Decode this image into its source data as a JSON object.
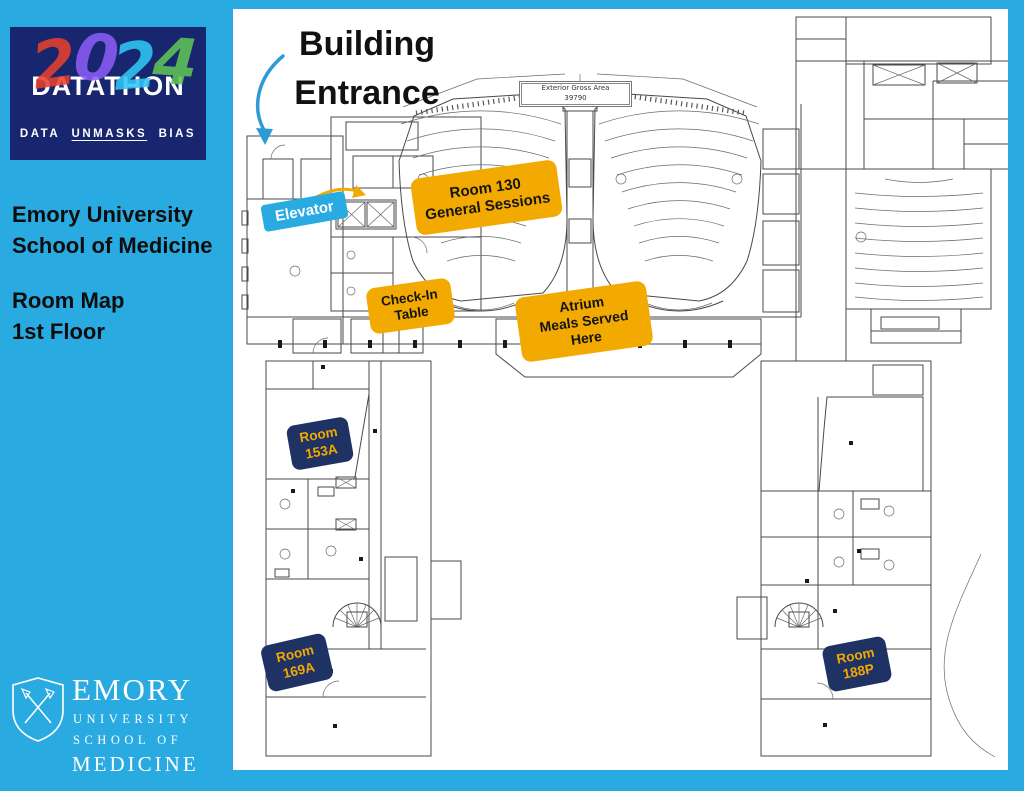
{
  "colors": {
    "background": "#29ABE2",
    "logo_navy": "#17266E",
    "label_orange": "#F2A900",
    "label_navy": "#1E3264",
    "label_gold_text": "#F2A900",
    "elevator_cyan": "#29ABE2",
    "entrance_arrow_blue": "#2E9BD6",
    "digit_colors": [
      "#E8412E",
      "#8B5CF6",
      "#30C6F4",
      "#5FC457"
    ]
  },
  "sidebar": {
    "logo": {
      "title": "DATATHON",
      "year_digits": [
        "2",
        "0",
        "2",
        "4"
      ],
      "tagline_words": [
        {
          "text": "DATA"
        },
        {
          "text": "UNMASKS"
        },
        {
          "text": "BIAS"
        }
      ]
    },
    "org_line1": "Emory University",
    "org_line2": "School of Medicine",
    "map_line1": "Room Map",
    "map_line2": "1st Floor",
    "footer_logo": {
      "name": "EMORY",
      "sub1": "UNIVERSITY",
      "sub2": "SCHOOL OF",
      "sub3": "MEDICINE"
    }
  },
  "map": {
    "annotations": {
      "entrance": {
        "line1": "Building",
        "line2": "Entrance"
      },
      "elevator": {
        "label": "Elevator"
      },
      "room130": {
        "line1": "Room 130",
        "line2": "General Sessions"
      },
      "checkin": {
        "line1": "Check-In",
        "line2": "Table"
      },
      "atrium": {
        "line1": "Atrium",
        "line2": "Meals Served",
        "line3": "Here"
      },
      "room153a": {
        "line1": "Room",
        "line2": "153A"
      },
      "room169a": {
        "line1": "Room",
        "line2": "169A"
      },
      "room188p": {
        "line1": "Room",
        "line2": "188P"
      }
    },
    "plan_text": {
      "gross_area_label": "Exterior Gross Area",
      "gross_area_value": "39790"
    }
  }
}
